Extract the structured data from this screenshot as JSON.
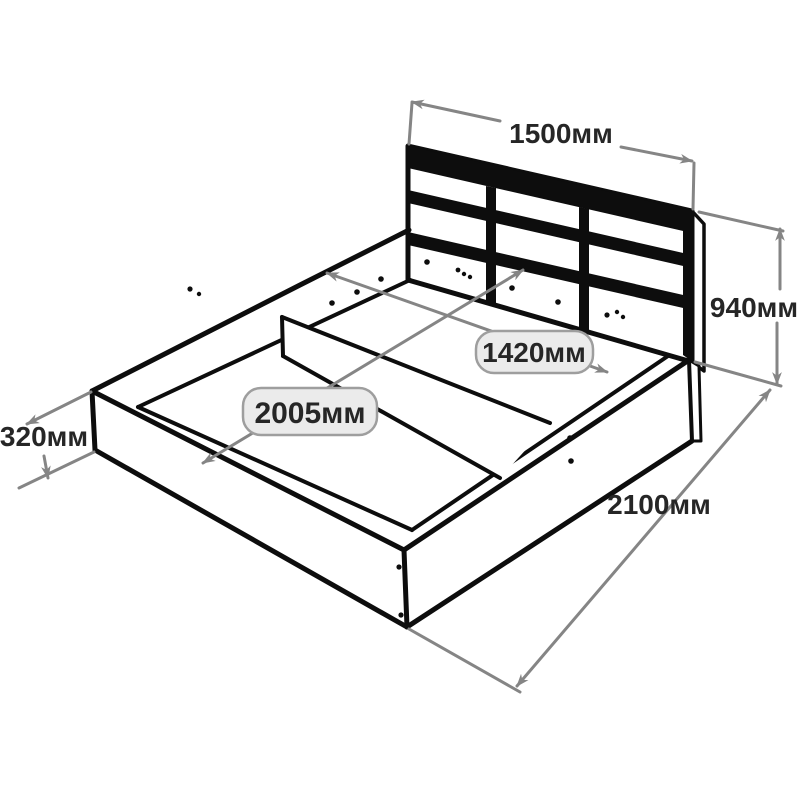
{
  "diagram": {
    "dimensions": {
      "headboard_width": "1500мм",
      "overall_height": "940мм",
      "frame_height": "320мм",
      "overall_length": "2100мм",
      "inner_width": "1420мм",
      "inner_length": "2005мм"
    },
    "colors": {
      "outline": "#0d0d0d",
      "dimension_line": "#858585",
      "badge_fill": "#ebebeb",
      "badge_border": "#9e9e9e",
      "label_text": "#262626",
      "background": "#ffffff"
    }
  }
}
